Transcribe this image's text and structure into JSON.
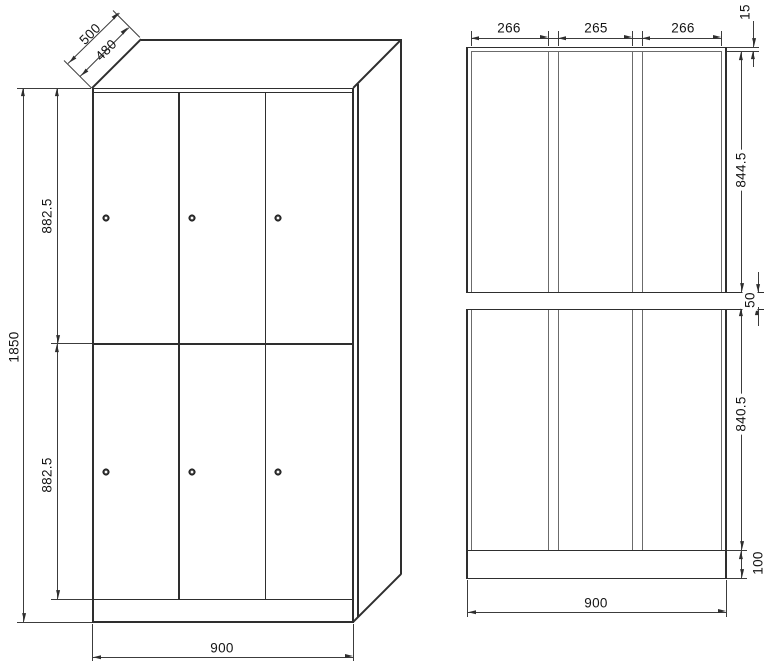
{
  "drawing": {
    "type": "locker-cabinet-technical-drawing",
    "views": {
      "oblique_view": {
        "depth_outer": "500",
        "depth_inner": "480",
        "height_total": "1850",
        "upper_door_height": "882.5",
        "lower_door_height": "882.5",
        "width": "900"
      },
      "front_view": {
        "door_widths": [
          "266",
          "265",
          "266"
        ],
        "top_frame": "15",
        "upper_door_height": "844.5",
        "mid_band": "50",
        "lower_door_height": "840.5",
        "plinth_height": "100",
        "width": "900"
      }
    },
    "colors": {
      "object_line": "#2e2e2e",
      "dimension_line": "#3c3c3c",
      "text": "#141414",
      "background": "#ffffff"
    }
  }
}
